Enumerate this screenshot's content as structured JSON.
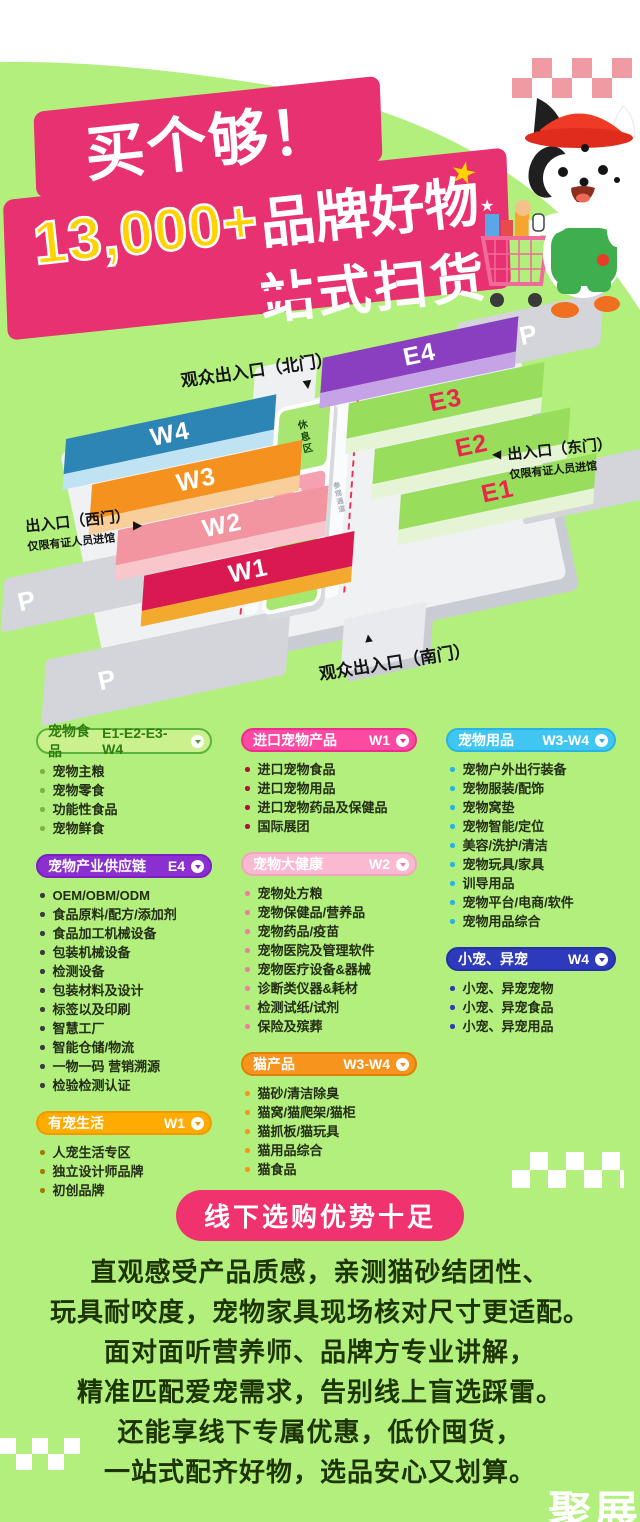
{
  "hero": {
    "title": "买个够！",
    "subtitle_number": "13,000+",
    "subtitle_text": "品牌好物",
    "subtitle2": "一站式扫货",
    "star_icon": "★"
  },
  "map": {
    "entrances": {
      "north": "观众出入口（北门）",
      "south": "观众出入口（南门）",
      "east": {
        "title": "出入口（东门）",
        "subtitle": "仅限有证人员进馆"
      },
      "west": {
        "title": "出入口（西门）",
        "subtitle": "仅限有证人员进馆"
      }
    },
    "arrows": {
      "down": "▼",
      "up": "▲",
      "left": "◀",
      "right": "▶"
    },
    "halls": {
      "west": [
        {
          "id": "w4",
          "label": "W4"
        },
        {
          "id": "w3",
          "label": "W3"
        },
        {
          "id": "w2",
          "label": "W2"
        },
        {
          "id": "w1",
          "label": "W1"
        }
      ],
      "east": [
        {
          "id": "e4",
          "label": "E4"
        },
        {
          "id": "e3",
          "label": "E3"
        },
        {
          "id": "e2",
          "label": "E2"
        },
        {
          "id": "e1",
          "label": "E1"
        }
      ]
    },
    "facilities": {
      "rest": "休息区",
      "dining": "餐饮区",
      "corridor": "参观通道",
      "parking": "P"
    }
  },
  "columns": [
    [
      {
        "id": "pet-food",
        "title": "宠物食品",
        "hall": "E1-E2-E3-W4",
        "theme": "food",
        "items": [
          "宠物主粮",
          "宠物零食",
          "功能性食品",
          "宠物鲜食"
        ]
      },
      {
        "id": "supply-chain",
        "title": "宠物产业供应链",
        "hall": "E4",
        "theme": "supply",
        "items": [
          "OEM/OBM/ODM",
          "食品原料/配方/添加剂",
          "食品加工机械设备",
          "包装机械设备",
          "检测设备",
          "包装材料及设计",
          "标签以及印刷",
          "智慧工厂",
          "智能仓储/物流",
          "一物一码 营销溯源",
          "检验检测认证"
        ]
      },
      {
        "id": "pet-life",
        "title": "有宠生活",
        "hall": "W1",
        "theme": "life",
        "items": [
          "人宠生活专区",
          "独立设计师品牌",
          "初创品牌"
        ]
      }
    ],
    [
      {
        "id": "imported",
        "title": "进口宠物产品",
        "hall": "W1",
        "theme": "import",
        "items": [
          "进口宠物食品",
          "进口宠物用品",
          "进口宠物药品及保健品",
          "国际展团"
        ]
      },
      {
        "id": "health",
        "title": "宠物大健康",
        "hall": "W2",
        "theme": "health",
        "items": [
          "宠物处方粮",
          "宠物保健品/营养品",
          "宠物药品/疫苗",
          "宠物医院及管理软件",
          "宠物医疗设备&器械",
          "诊断类仪器&耗材",
          "检测试纸/试剂",
          "保险及殡葬"
        ]
      },
      {
        "id": "cat-products",
        "title": "猫产品",
        "hall": "W3-W4",
        "theme": "cat",
        "items": [
          "猫砂/清洁除臭",
          "猫窝/猫爬架/猫柜",
          "猫抓板/猫玩具",
          "猫用品综合",
          "猫食品"
        ]
      }
    ],
    [
      {
        "id": "pet-supplies",
        "title": "宠物用品",
        "hall": "W3-W4",
        "theme": "supplies",
        "items": [
          "宠物户外出行装备",
          "宠物服装/配饰",
          "宠物窝垫",
          "宠物智能/定位",
          "美容/洗护/清洁",
          "宠物玩具/家具",
          "训导用品",
          "宠物平台/电商/软件",
          "宠物用品综合"
        ]
      },
      {
        "id": "small-exotic-pets",
        "title": "小宠、异宠",
        "hall": "W4",
        "theme": "exotic",
        "items": [
          "小宠、异宠宠物",
          "小宠、异宠食品",
          "小宠、异宠用品"
        ]
      }
    ]
  ],
  "bottom": {
    "badge": "线下选购优势十足",
    "lines": [
      "直观感受产品质感，亲测猫砂结团性、",
      "玩具耐咬度，宠物家具现场核对尺寸更适配。",
      "面对面听营养师、品牌方专业讲解，",
      "精准匹配爱宠需求，告别线上盲选踩雷。",
      "还能享线下专属优惠，低价囤货，",
      "一站式配齐好物，选品安心又划算。"
    ]
  },
  "watermark": "聚展",
  "colors": {
    "background": "#b3ef7d",
    "banner_pink": "#e73170",
    "accent_yellow": "#ffd200",
    "badge_pink": "#f0336f",
    "checker_pink": "#f09aa4"
  }
}
